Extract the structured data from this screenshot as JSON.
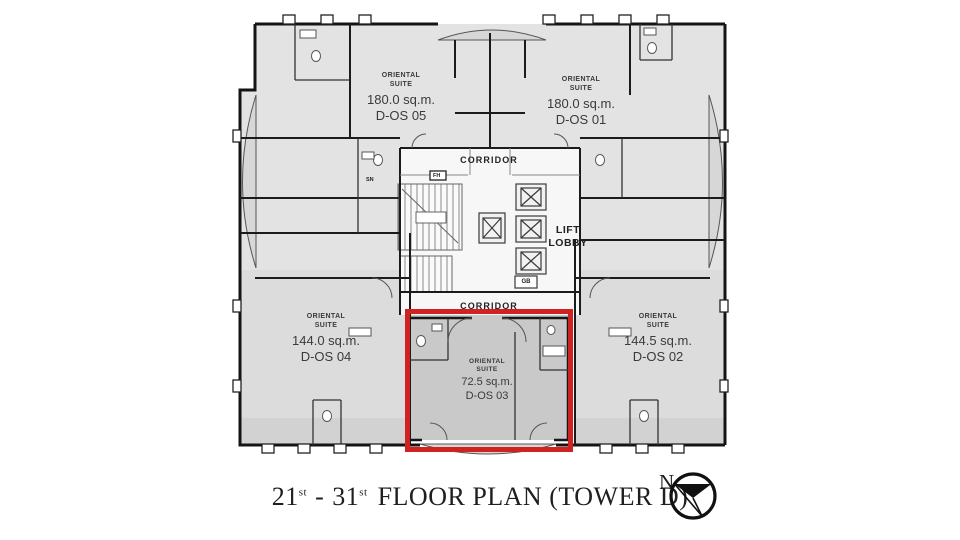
{
  "plan": {
    "units": {
      "os05": {
        "name": "ORIENTAL SUITE",
        "area": "180.0 sq.m.",
        "code": "D-OS 05"
      },
      "os01": {
        "name": "ORIENTAL SUITE",
        "area": "180.0 sq.m.",
        "code": "D-OS 01"
      },
      "os02": {
        "name": "ORIENTAL SUITE",
        "area": "144.5 sq.m.",
        "code": "D-OS 02"
      },
      "os03": {
        "name": "ORIENTAL SUITE",
        "area": "72.5 sq.m.",
        "code": "D-OS 03"
      },
      "os04": {
        "name": "ORIENTAL SUITE",
        "area": "144.0 sq.m.",
        "code": "D-OS 04"
      }
    },
    "core": {
      "corridor_top": "CORRIDOR",
      "corridor_bottom": "CORRIDOR",
      "lift_lobby": "LIFT LOBBY",
      "sn": "SN",
      "fh": "FH",
      "gb": "GB"
    },
    "highlight": {
      "unit": "D-OS 03",
      "color": "#cf2221"
    }
  },
  "caption": {
    "floor_start": "21",
    "floor_start_sup": "st",
    "separator": "-",
    "floor_end": "31",
    "floor_end_sup": "st",
    "rest": "FLOOR PLAN (TOWER D)"
  },
  "compass": {
    "north_label": "N"
  },
  "colors": {
    "wall": "#1a1a1a",
    "unit_fill": "#e3e3e3",
    "selected_unit_fill": "#c9c9c9",
    "balcony_fill": "#d7d7d7",
    "highlight": "#cf2221"
  }
}
